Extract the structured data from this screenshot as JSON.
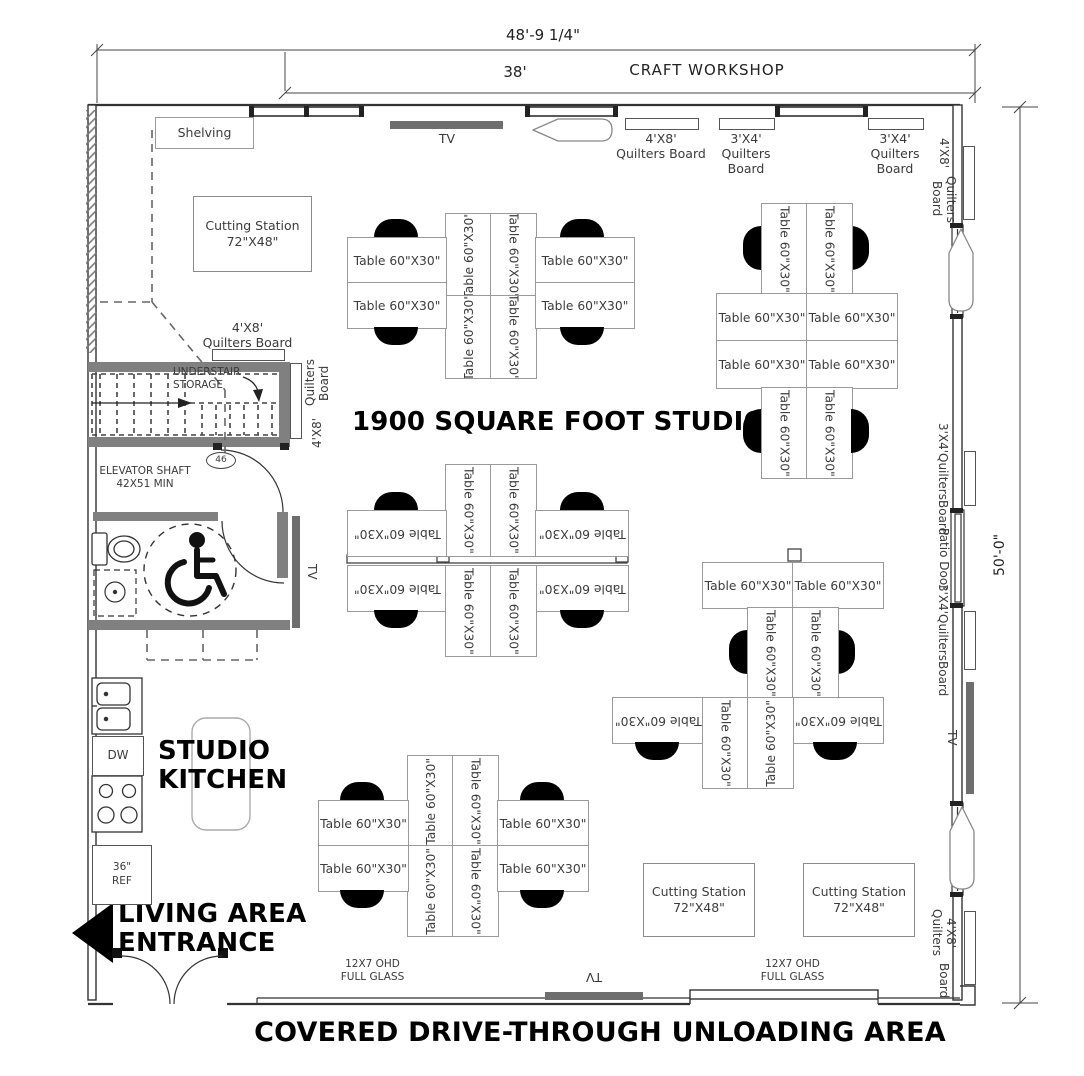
{
  "dims": {
    "overall_width": "48'-9 1/4\"",
    "partial_width": "38'",
    "side_height": "50'-0\""
  },
  "headings": {
    "workshop": "CRAFT WORKSHOP",
    "studio": "1900 SQUARE FOOT STUDIO",
    "kitchen_l1": "STUDIO",
    "kitchen_l2": "KITCHEN",
    "entrance_l1": "LIVING AREA",
    "entrance_l2": "ENTRANCE",
    "unloading": "COVERED DRIVE-THROUGH UNLOADING AREA"
  },
  "labels": {
    "table": "Table 60\"X30\"",
    "cutting_l1": "Cutting Station",
    "cutting_l2": "72\"X48\"",
    "shelving": "Shelving",
    "tv": "TV",
    "size_4x8": "4'X8'",
    "size_3x4": "3'X4'",
    "quilters_board": "Quilters Board",
    "quilters": "Quilters",
    "board": "Board",
    "qb_4x8_quilters": "4'X8' Quilters",
    "understair_l1": "UNDERSTAIR",
    "understair_l2": "STORAGE",
    "elevator_l1": "ELEVATOR SHAFT",
    "elevator_l2": "42X51 MIN",
    "door_num": "46",
    "dw": "DW",
    "ref_l1": "36\"",
    "ref_l2": "REF",
    "patio": "Patio Door",
    "ohd_l1": "12X7 OHD",
    "ohd_l2": "FULL GLASS"
  },
  "colors": {
    "line": "#333333",
    "gray_wall": "#808080",
    "tv_bar": "#6e6e6e",
    "chair": "#000000",
    "text": "#3a3a3a"
  }
}
